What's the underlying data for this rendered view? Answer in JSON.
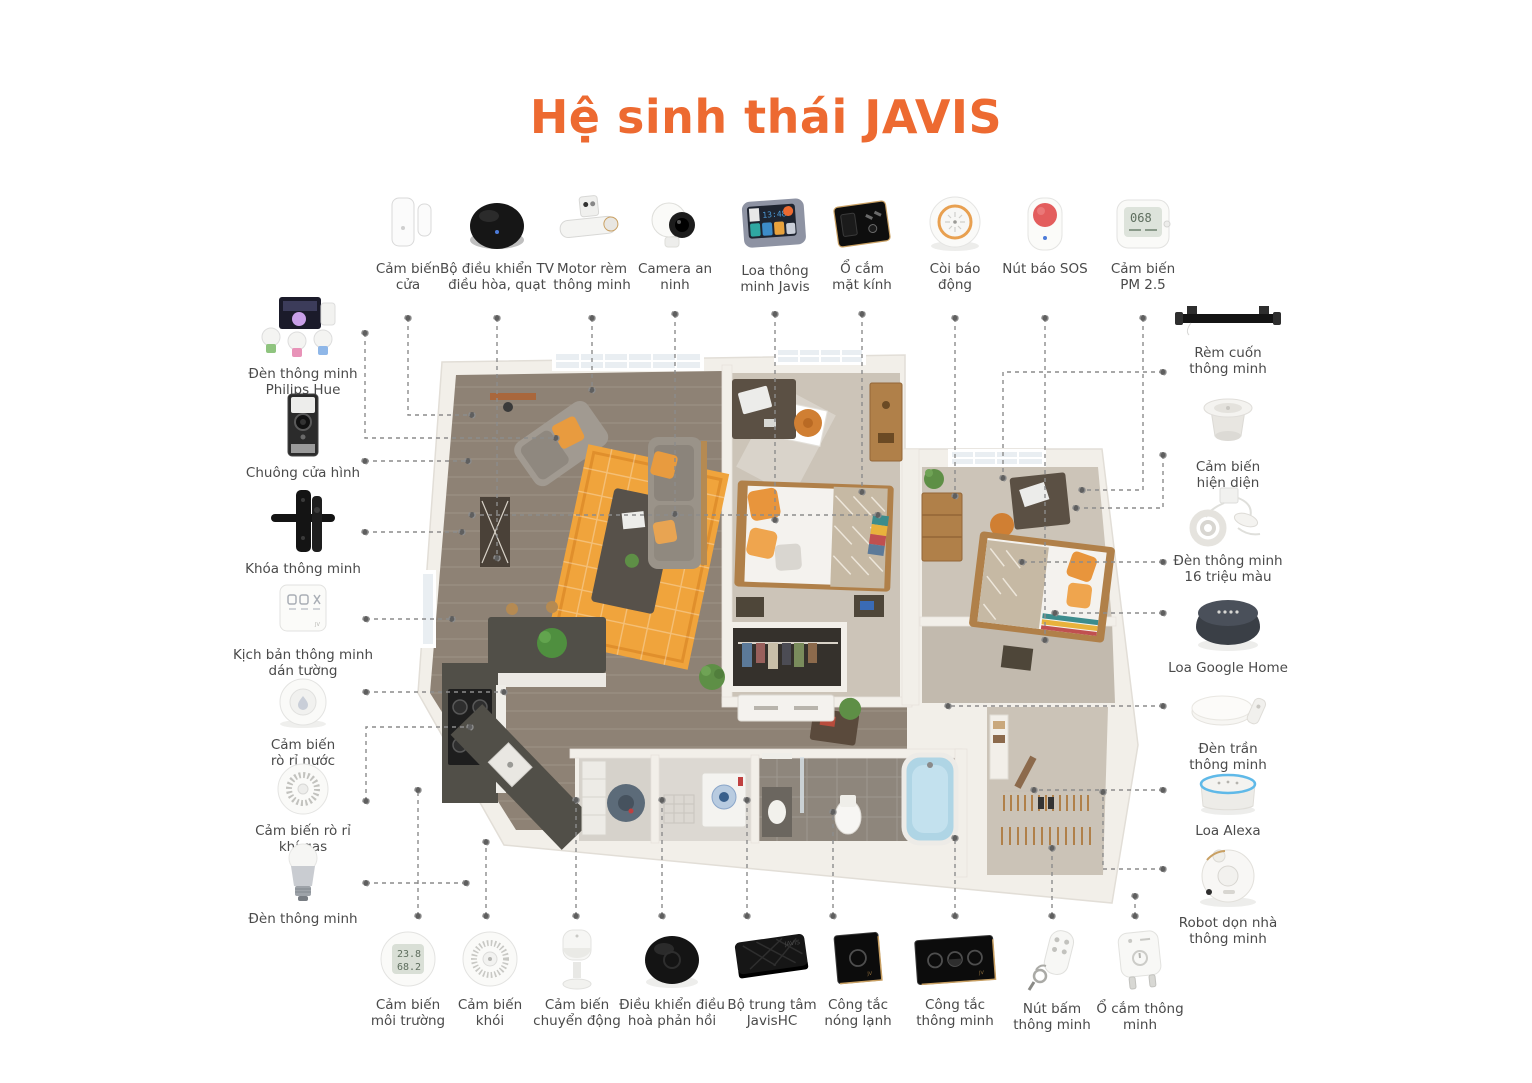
{
  "title": "Hệ sinh thái JAVIS",
  "colors": {
    "accent": "#ED6A31",
    "label_text": "#4A4A4A",
    "connector_line": "#8C8C8C",
    "rug_orange": "#F0A43C",
    "wood_floor": "#8E8275",
    "carpet": "#CCC4B8",
    "wall": "#F2EFE9",
    "tub_blue": "#AFD5E5"
  },
  "screens": {
    "javis_display_time": "13:48",
    "pm25_value": "068",
    "env_temp": "23.8",
    "env_humidity": "68.2"
  },
  "devices": {
    "top": [
      {
        "name": "door-sensor",
        "label": "Cảm biến cửa"
      },
      {
        "name": "tv-ac-fan-controller",
        "label": "Bộ điều khiển TV điều hòa, quạt"
      },
      {
        "name": "curtain-motor",
        "label": "Motor rèm thông minh"
      },
      {
        "name": "security-camera",
        "label": "Camera an ninh"
      },
      {
        "name": "javis-smart-speaker",
        "label": "Loa thông minh Javis"
      },
      {
        "name": "glass-socket",
        "label": "Ổ cắm mặt kính"
      },
      {
        "name": "alarm-siren",
        "label": "Còi báo động"
      },
      {
        "name": "sos-button",
        "label": "Nút báo SOS"
      },
      {
        "name": "pm25-sensor",
        "label": "Cảm biến PM 2.5"
      }
    ],
    "left": [
      {
        "name": "philips-hue-kit",
        "label": "Đèn thông minh Philips Hue"
      },
      {
        "name": "video-doorbell",
        "label": "Chuông cửa hình"
      },
      {
        "name": "smart-lock",
        "label": "Khóa thông minh"
      },
      {
        "name": "scene-panel",
        "label": "Kịch bản thông minh dán tường"
      },
      {
        "name": "water-leak-sensor",
        "label": "Cảm biến rò rỉ nước"
      },
      {
        "name": "gas-leak-sensor",
        "label": "Cảm biến rò rỉ khí gas"
      },
      {
        "name": "smart-bulb",
        "label": "Đèn thông minh"
      }
    ],
    "right": [
      {
        "name": "roller-blind",
        "label": "Rèm cuốn thông minh"
      },
      {
        "name": "presence-sensor",
        "label": "Cảm biến hiện diện"
      },
      {
        "name": "led-strip-16m",
        "label": "Đèn thông minh 16 triệu màu"
      },
      {
        "name": "google-home-speaker",
        "label": "Loa Google Home"
      },
      {
        "name": "ceiling-light",
        "label": "Đèn trần thông minh"
      },
      {
        "name": "alexa-speaker",
        "label": "Loa Alexa"
      },
      {
        "name": "robot-vacuum",
        "label": "Robot dọn nhà thông minh"
      }
    ],
    "bottom": [
      {
        "name": "environment-sensor",
        "label": "Cảm biến môi trường"
      },
      {
        "name": "smoke-sensor",
        "label": "Cảm biến khói"
      },
      {
        "name": "motion-sensor",
        "label": "Cảm biến chuyển động"
      },
      {
        "name": "ac-feedback-controller",
        "label": "Điều khiển điều hoà phản hồi"
      },
      {
        "name": "javis-hub",
        "label": "Bộ trung tâm JavisHC"
      },
      {
        "name": "water-heater-switch",
        "label": "Công tắc nóng lạnh"
      },
      {
        "name": "smart-switch",
        "label": "Công tắc thông minh"
      },
      {
        "name": "smart-button",
        "label": "Nút bấm thông minh"
      },
      {
        "name": "smart-plug",
        "label": "Ổ cắm thông minh"
      }
    ]
  }
}
